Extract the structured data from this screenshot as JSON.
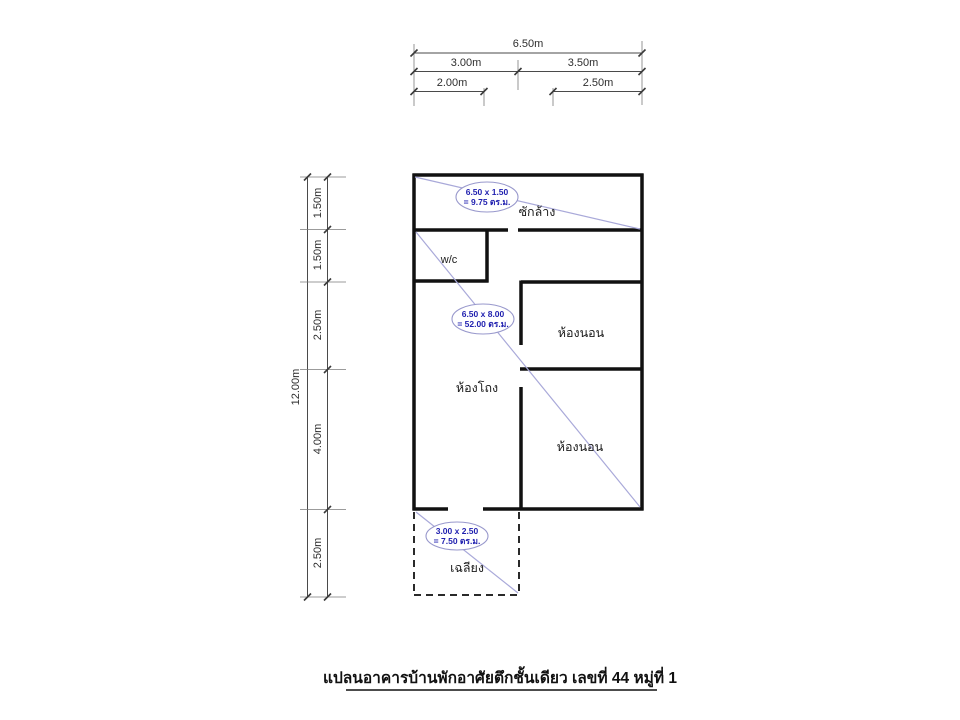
{
  "title": {
    "text": "แปลนอาคารบ้านพักอาศัยตึกชั้นเดียว เลขที่ 44 หมู่ที่ 1"
  },
  "dimensions": {
    "top": {
      "total": "6.50m",
      "left_half": "3.00m",
      "right_half": "3.50m",
      "sub_left": "2.00m",
      "sub_right": "2.50m"
    },
    "left": {
      "total": "12.00m",
      "seg1": "1.50m",
      "seg2": "1.50m",
      "seg3": "2.50m",
      "seg4": "4.00m",
      "seg5": "2.50m"
    }
  },
  "rooms": {
    "laundry": "ซักล้าง",
    "toilet": "w/c",
    "bedroom_top": "ห้องนอน",
    "hall": "ห้องโถง",
    "bedroom_bottom": "ห้องนอน",
    "porch": "เฉลียง"
  },
  "area_callouts": {
    "laundry": {
      "formula": "6.50 x 1.50",
      "area": "= 9.75 ตร.ม."
    },
    "main": {
      "formula": "6.50 x 8.00",
      "area": "= 52.00 ตร.ม."
    },
    "porch": {
      "formula": "3.00 x 2.50",
      "area": "= 7.50 ตร.ม."
    }
  },
  "colors": {
    "wall": "#111111",
    "dimension_line": "#4a4a4a",
    "diagonal_line": "#a9a9d9",
    "callout_outline": "#9898cc",
    "callout_text": "#1f1faf",
    "label_text": "#1a1a1a"
  }
}
